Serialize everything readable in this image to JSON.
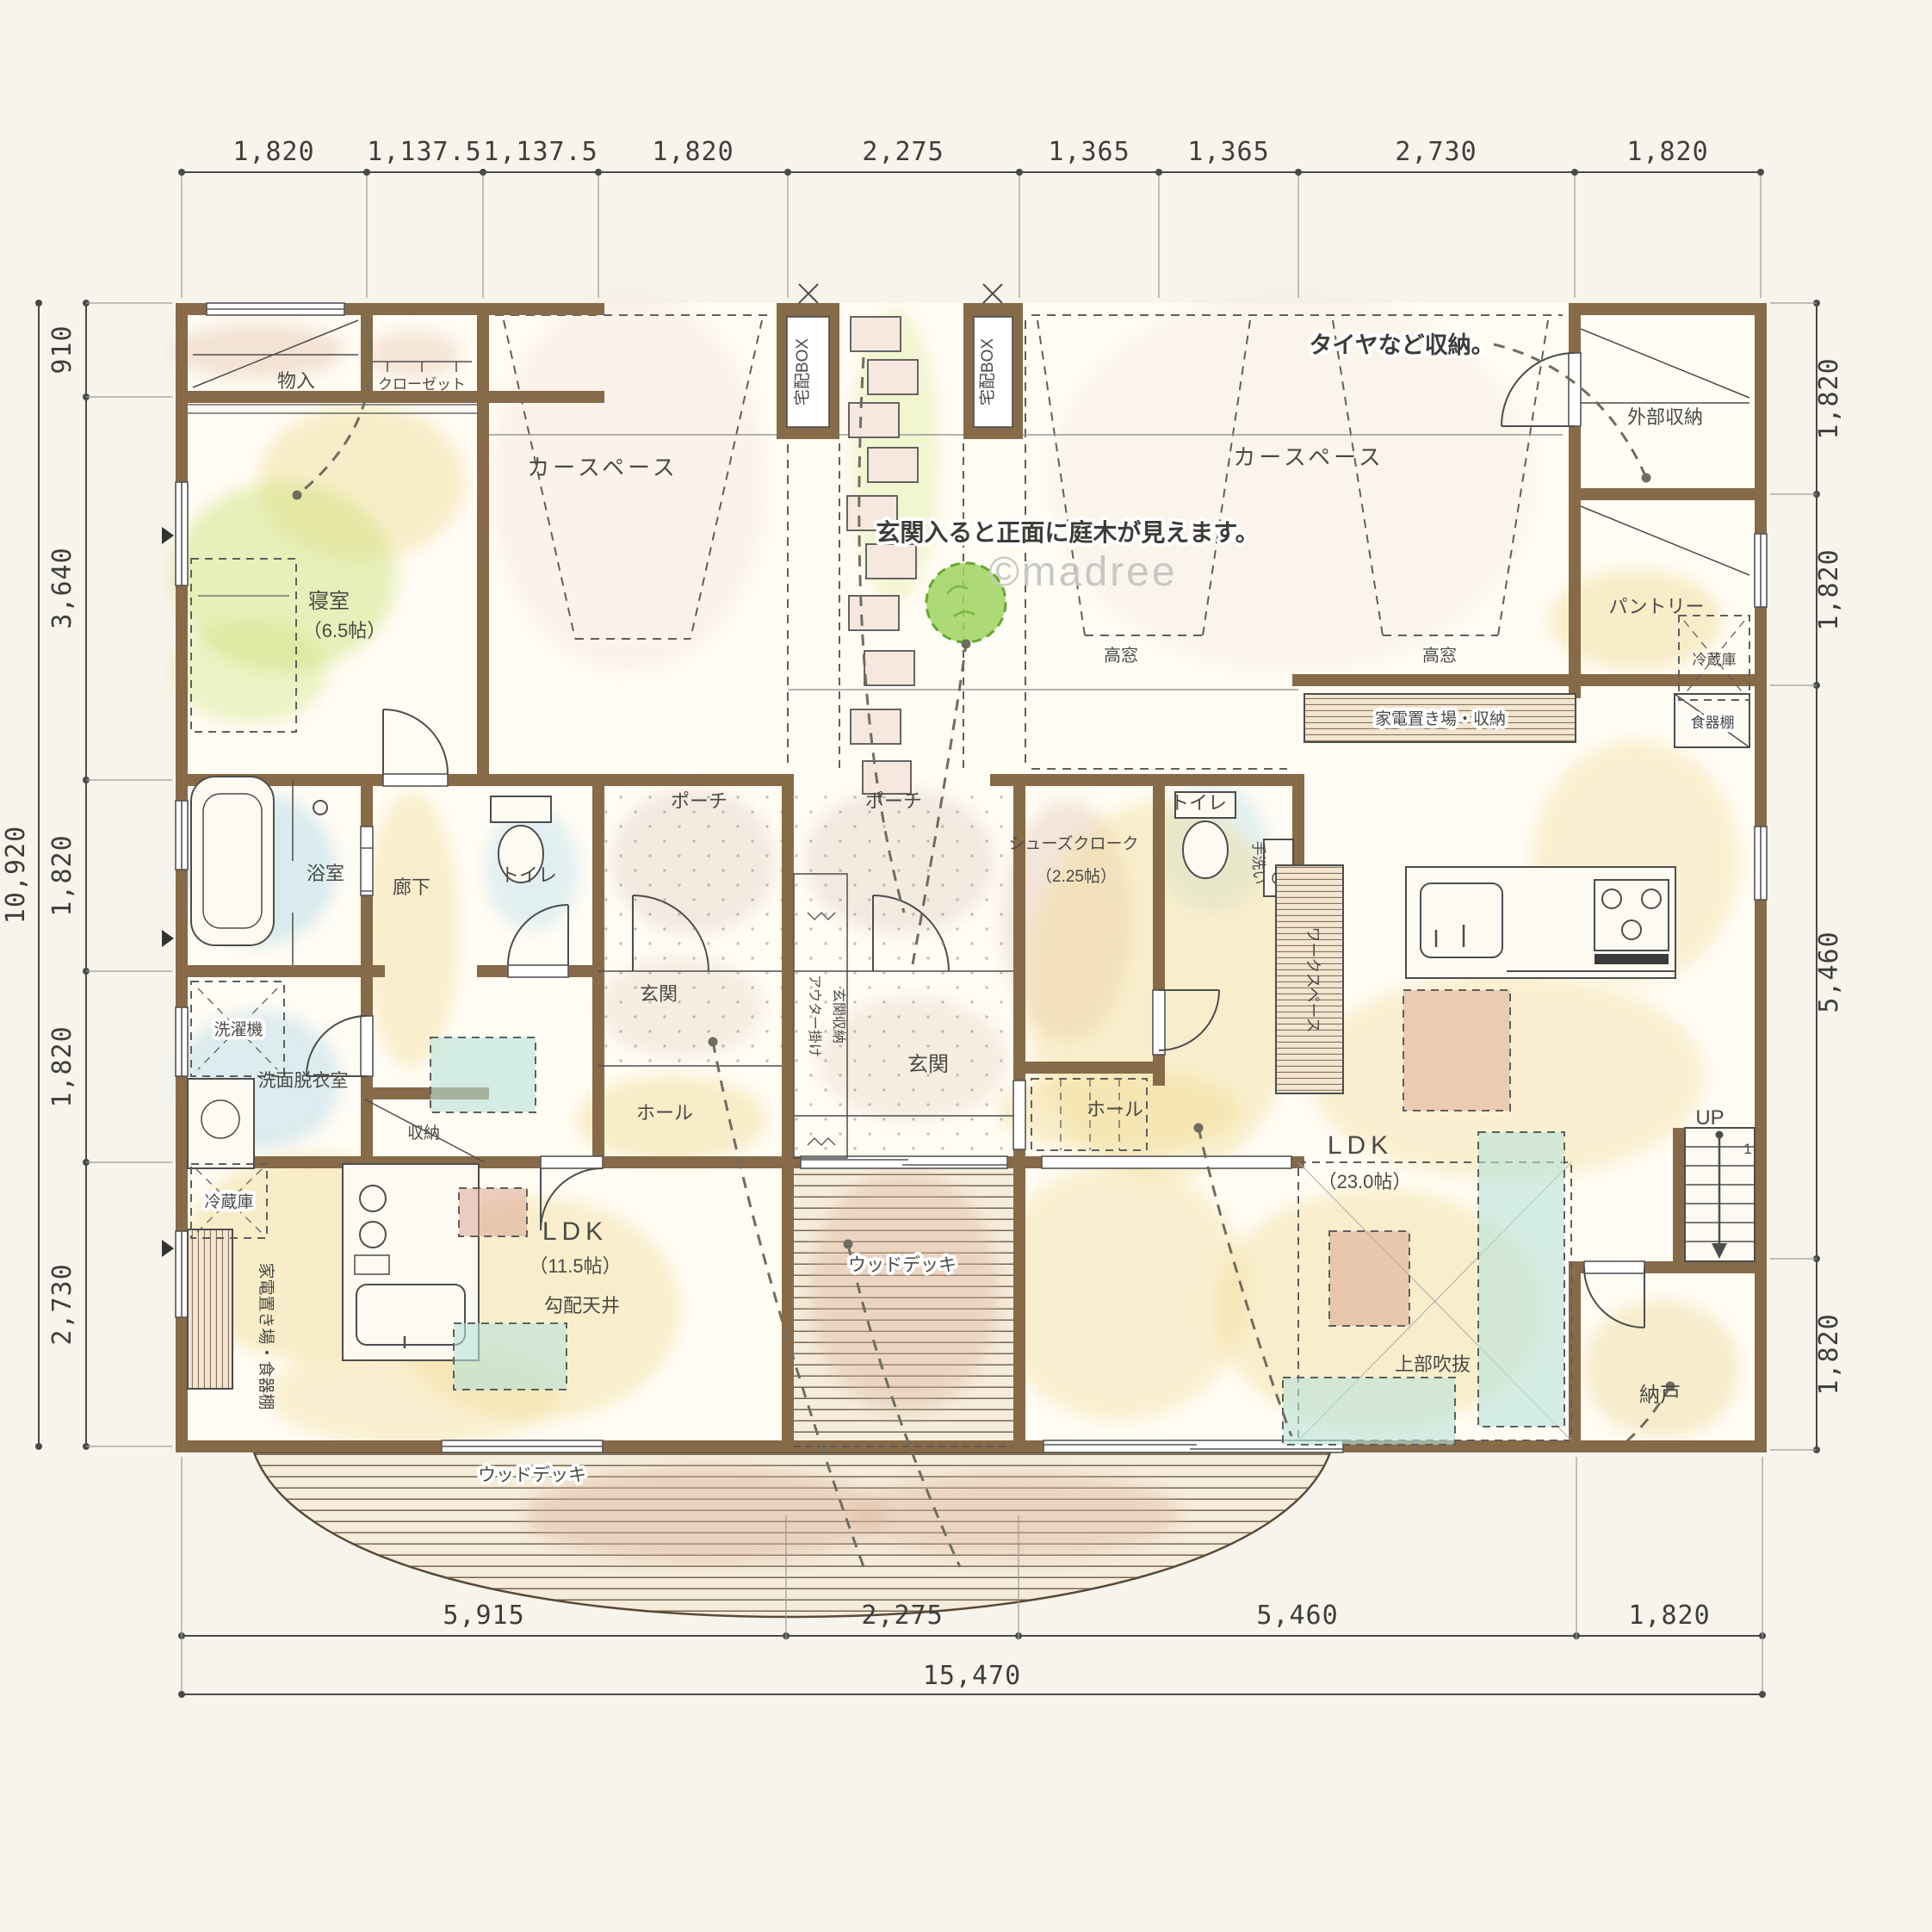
{
  "watermark": "©madree",
  "dims": {
    "top": [
      "1,820",
      "1,137.5",
      "1,137.5",
      "1,820",
      "2,275",
      "1,365",
      "1,365",
      "2,730",
      "1,820"
    ],
    "left": [
      "910",
      "3,640",
      "1,820",
      "1,820",
      "2,730"
    ],
    "left_total": "10,920",
    "right": [
      "1,820",
      "1,820",
      "5,460",
      "1,820"
    ],
    "bottom": [
      "5,915",
      "2,275",
      "5,460",
      "1,820"
    ],
    "bottom_total": "15,470"
  },
  "annotations": {
    "tire_storage": "タイヤなど収納。",
    "garden_view": "玄関入ると正面に庭木が見えます。"
  },
  "rooms": {
    "monoire": "物入",
    "closet": "クローゼット",
    "bedroom": "寝室",
    "bedroom_size": "（6.5帖）",
    "carspace_left": "カースペース",
    "carspace_right": "カースペース",
    "takuhai_left": "宅配BOX",
    "takuhai_right": "宅配BOX",
    "takamado_left": "高窓",
    "takamado_right": "高窓",
    "gaibu_shuno": "外部収納",
    "pantry": "パントリー",
    "fridge_right": "冷蔵庫",
    "shokkidana": "食器棚",
    "kaden_shuno": "家電置き場・収納",
    "porch_left": "ポーチ",
    "porch_center": "ポーチ",
    "shoes_cloak": "シューズクローク",
    "shoes_cloak_size": "（2.25帖）",
    "toilet_left": "トイレ",
    "toilet_right": "トイレ",
    "tearai": "手洗い",
    "genkan_left": "玄関",
    "genkan_center": "玄関",
    "hall_left": "ホール",
    "hall_right": "ホール",
    "outer_hook": "アウター掛け",
    "genkan_shuno": "玄関収納",
    "roka": "廊下",
    "bath": "浴室",
    "washer": "洗濯機",
    "senmen": "洗面脱衣室",
    "shuno": "収納",
    "fridge_left": "冷蔵庫",
    "kaden_shokki": "家電置き場・食器棚",
    "ldk_left": "LDK",
    "ldk_left_size": "（11.5帖）",
    "kobai_tenjo": "勾配天井",
    "ldk_right": "LDK",
    "ldk_right_size": "（23.0帖）",
    "fukinuke": "上部吹抜",
    "nando": "納戸",
    "workspace": "ワークスペース",
    "up": "UP",
    "stair_first": "1",
    "wood_deck_mid": "ウッドデッキ",
    "wood_deck_bottom": "ウッドデッキ"
  },
  "colors": {
    "wall": "#876a48",
    "line": "#4d4d4d",
    "crayon_yellow": "#f2dd9b",
    "crayon_green": "#cfe47f",
    "crayon_blue": "#b9dcea",
    "accent_teal": "#b8e3d8",
    "accent_red": "#d9a08e",
    "deck_pink": "#dcb49e"
  }
}
